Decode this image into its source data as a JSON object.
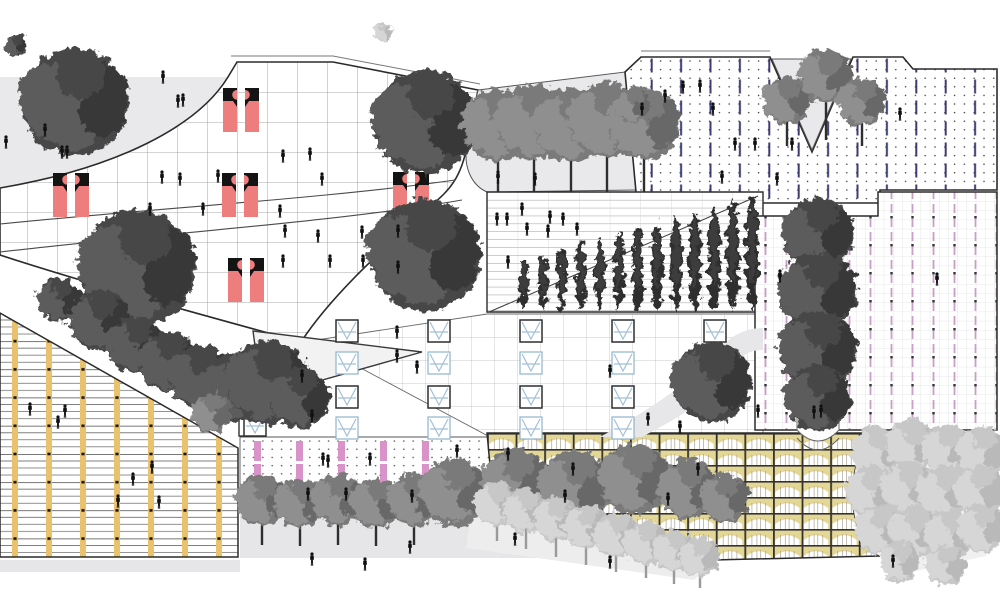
{
  "image_kind": "architectural-roof-plan-drawing",
  "canvas": {
    "w": 1000,
    "h": 600
  },
  "palette": {
    "paper": "#ffffff",
    "gray_zone": "#e9e9eb",
    "gray_zone2": "#e6e6e8",
    "line_dark": "#2b2b2b",
    "grid_main": "#8d8d8d",
    "grid_fine": "#d2d2d2",
    "grid_soft": "#b8b8b8",
    "salmon": "#ee7e7e",
    "cap_black": "#141414",
    "navy_dash": "#3c3c72",
    "mauve_dash": "#c89fc6",
    "pink_bar": "#da93c9",
    "yellow_post": "#eac26e",
    "vault_tan": "#e4d795",
    "vault_line": "#9a9483",
    "skylight_blue": "#a3c0d6",
    "skylight_dark": "#2f2f2f",
    "people": "#101010",
    "tree_dark": [
      "#474747",
      "#5b5b5b",
      "#393939"
    ],
    "tree_medium": [
      "#7a7a7a",
      "#8f8f8f",
      "#686868"
    ],
    "tree_light": [
      "#c7c7c7",
      "#d6d6d6",
      "#b9b9b9"
    ],
    "cypress": "#2e2e2e",
    "trunk_dark": "#2e2e2e",
    "trunk_light": "#9a9a9a"
  },
  "zones": [
    {
      "n": "plaza-topleft",
      "p": "M0,77 L228,77 C198,126 118,168 0,188 Z",
      "bg": "#e9e9eb"
    },
    {
      "n": "main-grid-plaza",
      "p": "M237,62 L333,62 L478,90 L467,145 C462,176 449,192 430,206 C381,251 331,296 301,342 C199,314 92,285 0,255 L0,188 C118,168 198,126 228,77 Z",
      "bg": "#ffffff",
      "pats": [
        "grid30"
      ],
      "s": "#2b2b2b",
      "sw": 1.6
    },
    {
      "n": "gray-notch",
      "p": "M478,90 L625,72 L637,190 L487,192 C471,185 463,166 467,145 Z",
      "bg": "#e9e9eb",
      "s": "#555555",
      "sw": 1
    },
    {
      "n": "dotted-roof",
      "p": "M625,72 L641,57 L770,57 L812,152 L853,57 L903,57 L913,69 L997,69 L997,190 L880,190 L880,203 L637,203 Z",
      "bg": "#ffffff",
      "pats": [
        "dots",
        "navy"
      ],
      "s": "#2b2b2b",
      "sw": 1.6
    },
    {
      "n": "cypress-terrace",
      "p": "M487,192 L763,192 L763,312 L487,312 Z",
      "bg": "#ffffff",
      "pats": [
        "hgrid"
      ],
      "s": "#2b2b2b",
      "sw": 1.4
    },
    {
      "n": "skylight-hall",
      "p": "M310,341 L487,314 L763,314 L763,437 L490,437 Z",
      "bg": "#ffffff",
      "pats": [
        "grid23"
      ],
      "s": "#6a6a6a",
      "sw": 0.9
    },
    {
      "n": "louver-deck",
      "p": "M0,313 L238,448 L238,557 L0,557 Z",
      "bg": "#ffffff",
      "pats": [
        "louver"
      ],
      "s": "#2b2b2b",
      "sw": 1.5
    },
    {
      "n": "right-terrace",
      "p": "M755,216 L878,216 L878,192 L997,192 L997,430 L755,430 Z",
      "bg": "#ffffff",
      "pats": [
        "grid9",
        "mauve"
      ],
      "s": "#2b2b2b",
      "sw": 1.5
    },
    {
      "n": "dot-pink-court",
      "p": "M240,437 L500,437 L500,512 L240,512 Z",
      "bg": "#ffffff",
      "pats": [
        "dots2"
      ],
      "s": "#555555",
      "sw": 0.9
    },
    {
      "n": "ground-bottom",
      "p": "M240,498 L740,498 L740,558 L240,558 Z",
      "bg": "#e6e6e8"
    },
    {
      "n": "vault-roof",
      "p": "M487,433 L878,433 C846,447 842,538 880,556 L713,560 L490,465 Z",
      "bg": "#ffffff",
      "pats": [
        "vault"
      ],
      "s": "#2b2b2b",
      "sw": 1.5
    },
    {
      "n": "allee-ground",
      "p": "M478,468 L712,564 L694,580 L466,548 Z",
      "bg": "#ededee"
    },
    {
      "n": "grove-ground",
      "p": "M878,433 L997,433 L997,468 L986,556 L902,574 L880,556 C842,538 846,447 878,433 Z",
      "bg": "#f0f0f0"
    }
  ],
  "shapes": [
    {
      "n": "parapet-main",
      "p": "M231,56 L333,56 L480,84",
      "s": "#777777",
      "sw": 1
    },
    {
      "n": "parapet-dotted",
      "p": "M641,51 L770,51",
      "s": "#777777",
      "sw": 1
    },
    {
      "n": "v-court",
      "p": "M772,59 L812,150 L851,59 Z",
      "f": "#e9e9eb",
      "s": "#555555",
      "sw": 1
    },
    {
      "n": "terrace-curve-1",
      "p": "M0,224 C160,208 330,198 455,180",
      "s": "#4a4a4a",
      "sw": 1.1
    },
    {
      "n": "terrace-curve-2",
      "p": "M0,252 C165,233 335,222 462,200",
      "s": "#4a4a4a",
      "sw": 1.1
    },
    {
      "n": "cypress-diagonal",
      "p": "M489,312 L758,196",
      "s": "#444444",
      "sw": 1.1
    },
    {
      "n": "white-wedge",
      "p": "M253,331 L422,352 L262,397 Z",
      "f": "#f2f2f3",
      "s": "#3a3a3a",
      "sw": 1.4
    },
    {
      "n": "curved-path",
      "p": "M600,437 C652,408 692,382 716,352 C731,335 746,328 763,328 L763,350 C747,350 739,357 726,376 C706,404 666,424 642,437 Z",
      "f": "#e7e7e9"
    },
    {
      "n": "louver-base-strip",
      "p": "M0,560 L240,560 L240,572 L0,572 Z",
      "f": "#e6e6e8"
    },
    {
      "n": "tree-strip",
      "p": "M797,216 L839,216 L839,430 Q818,452 797,430 Z",
      "f": "#fdfdfd",
      "s": "#666666",
      "sw": 1
    },
    {
      "n": "tree-strip-arc",
      "p": "M797,438 Q818,462 839,438",
      "s": "#666666",
      "sw": 1
    },
    {
      "n": "elevator-box",
      "p": "M239,418 L252,418 L252,436 L239,436 Z",
      "f": "#ffffff",
      "s": "#222222",
      "sw": 1.3
    }
  ],
  "escalators": [
    [
      223,
      88
    ],
    [
      53,
      173
    ],
    [
      222,
      173
    ],
    [
      393,
      172
    ],
    [
      228,
      258
    ]
  ],
  "skylights": {
    "size": 22,
    "cols": [
      {
        "x": 336,
        "rows": [
          320,
          352,
          386,
          417
        ]
      },
      {
        "x": 428,
        "rows": [
          320,
          352,
          386,
          417
        ]
      },
      {
        "x": 520,
        "rows": [
          320,
          352,
          386,
          417
        ]
      },
      {
        "x": 612,
        "rows": [
          320,
          352,
          386,
          417
        ]
      },
      {
        "x": 704,
        "rows": [
          320,
          352,
          386
        ]
      },
      {
        "x": 244,
        "rows": [
          414
        ]
      }
    ]
  },
  "pink_bars": {
    "cols": [
      254,
      296,
      338,
      380,
      422
    ],
    "rows": [
      441,
      464,
      487
    ],
    "w": 7,
    "h": 20
  },
  "cypress_row": {
    "x0": 524,
    "dx": 19,
    "n": 13,
    "baseY": 310,
    "hMin": 52,
    "hMax": 114,
    "w0": 9,
    "w1": 13
  },
  "trees": [
    [
      "d",
      75,
      102,
      54
    ],
    [
      "d",
      425,
      122,
      52
    ],
    [
      "d",
      425,
      255,
      56
    ],
    [
      "d",
      16,
      46,
      11
    ],
    [
      "m",
      498,
      125,
      36,
      192
    ],
    [
      "m",
      534,
      122,
      38,
      192
    ],
    [
      "m",
      571,
      125,
      37,
      192
    ],
    [
      "m",
      607,
      120,
      38,
      192
    ],
    [
      "m",
      644,
      124,
      36,
      192
    ],
    [
      "m",
      787,
      100,
      24,
      146
    ],
    [
      "m",
      826,
      76,
      27,
      140
    ],
    [
      "m",
      862,
      102,
      24,
      146
    ],
    [
      "m",
      633,
      105,
      17
    ],
    [
      "d",
      138,
      268,
      58
    ],
    [
      "d",
      60,
      300,
      22
    ],
    [
      "d",
      100,
      320,
      30
    ],
    [
      "d",
      135,
      345,
      28
    ],
    [
      "d",
      168,
      362,
      30
    ],
    [
      "d",
      200,
      377,
      32
    ],
    [
      "d",
      235,
      388,
      34
    ],
    [
      "d",
      268,
      382,
      42
    ],
    [
      "d",
      300,
      398,
      30
    ],
    [
      "d",
      818,
      234,
      36
    ],
    [
      "d",
      818,
      292,
      39
    ],
    [
      "d",
      818,
      350,
      39
    ],
    [
      "d",
      818,
      398,
      33
    ],
    [
      "d",
      712,
      382,
      40
    ],
    [
      "m",
      212,
      413,
      20
    ],
    [
      "m",
      262,
      500,
      26,
      545
    ],
    [
      "m",
      300,
      503,
      25,
      546
    ],
    [
      "m",
      338,
      500,
      26,
      545
    ],
    [
      "m",
      376,
      503,
      25,
      546
    ],
    [
      "m",
      414,
      500,
      26,
      545
    ],
    [
      "m",
      455,
      492,
      34
    ],
    [
      "m",
      515,
      482,
      33
    ],
    [
      "m",
      575,
      486,
      36
    ],
    [
      "m",
      635,
      479,
      35
    ],
    [
      "m",
      688,
      489,
      30
    ],
    [
      "m",
      725,
      498,
      24
    ],
    [
      "l",
      383,
      32,
      9
    ],
    [
      "l",
      497,
      503,
      22,
      541
    ],
    [
      "l",
      526,
      511,
      22,
      549
    ],
    [
      "l",
      556,
      519,
      22,
      557
    ],
    [
      "l",
      586,
      527,
      22,
      565
    ],
    [
      "l",
      616,
      535,
      22,
      572
    ],
    [
      "l",
      646,
      543,
      22,
      578
    ],
    [
      "l",
      674,
      551,
      21,
      584
    ],
    [
      "l",
      700,
      557,
      20,
      588
    ],
    [
      "l",
      878,
      452,
      26
    ],
    [
      "l",
      912,
      446,
      26
    ],
    [
      "l",
      948,
      450,
      26
    ],
    [
      "l",
      982,
      452,
      25
    ],
    [
      "l",
      872,
      492,
      26
    ],
    [
      "l",
      908,
      488,
      27
    ],
    [
      "l",
      944,
      492,
      26
    ],
    [
      "l",
      980,
      490,
      25
    ],
    [
      "l",
      880,
      530,
      25
    ],
    [
      "l",
      915,
      532,
      26
    ],
    [
      "l",
      950,
      534,
      25
    ],
    [
      "l",
      982,
      528,
      24
    ],
    [
      "l",
      900,
      562,
      20
    ],
    [
      "l",
      945,
      565,
      20
    ]
  ],
  "people": [
    [
      163,
      78
    ],
    [
      178,
      102
    ],
    [
      183,
      101
    ],
    [
      45,
      131
    ],
    [
      6,
      143
    ],
    [
      62,
      153
    ],
    [
      67,
      153
    ],
    [
      310,
      155
    ],
    [
      162,
      178
    ],
    [
      180,
      180
    ],
    [
      218,
      177
    ],
    [
      322,
      180
    ],
    [
      283,
      157
    ],
    [
      150,
      210
    ],
    [
      203,
      210
    ],
    [
      280,
      212
    ],
    [
      285,
      232
    ],
    [
      318,
      237
    ],
    [
      362,
      233
    ],
    [
      398,
      232
    ],
    [
      283,
      262
    ],
    [
      330,
      262
    ],
    [
      363,
      262
    ],
    [
      398,
      268
    ],
    [
      498,
      178
    ],
    [
      535,
      180
    ],
    [
      683,
      88
    ],
    [
      700,
      87
    ],
    [
      665,
      97
    ],
    [
      713,
      110
    ],
    [
      642,
      110
    ],
    [
      735,
      145
    ],
    [
      755,
      145
    ],
    [
      792,
      145
    ],
    [
      722,
      178
    ],
    [
      777,
      180
    ],
    [
      900,
      115
    ],
    [
      497,
      220
    ],
    [
      507,
      220
    ],
    [
      550,
      218
    ],
    [
      563,
      220
    ],
    [
      527,
      230
    ],
    [
      548,
      232
    ],
    [
      577,
      230
    ],
    [
      508,
      263
    ],
    [
      522,
      210
    ],
    [
      397,
      333
    ],
    [
      397,
      357
    ],
    [
      417,
      368
    ],
    [
      302,
      377
    ],
    [
      312,
      417
    ],
    [
      610,
      372
    ],
    [
      648,
      420
    ],
    [
      680,
      428
    ],
    [
      30,
      410
    ],
    [
      65,
      412
    ],
    [
      58,
      423
    ],
    [
      133,
      480
    ],
    [
      152,
      468
    ],
    [
      118,
      502
    ],
    [
      159,
      503
    ],
    [
      780,
      277
    ],
    [
      937,
      280
    ],
    [
      758,
      412
    ],
    [
      814,
      413
    ],
    [
      821,
      412
    ],
    [
      323,
      460
    ],
    [
      328,
      462
    ],
    [
      370,
      460
    ],
    [
      308,
      495
    ],
    [
      346,
      495
    ],
    [
      412,
      497
    ],
    [
      457,
      452
    ],
    [
      508,
      455
    ],
    [
      573,
      470
    ],
    [
      698,
      470
    ],
    [
      668,
      500
    ],
    [
      565,
      497
    ],
    [
      610,
      563
    ],
    [
      893,
      562
    ],
    [
      312,
      560
    ],
    [
      365,
      565
    ],
    [
      410,
      548
    ],
    [
      515,
      540
    ]
  ]
}
